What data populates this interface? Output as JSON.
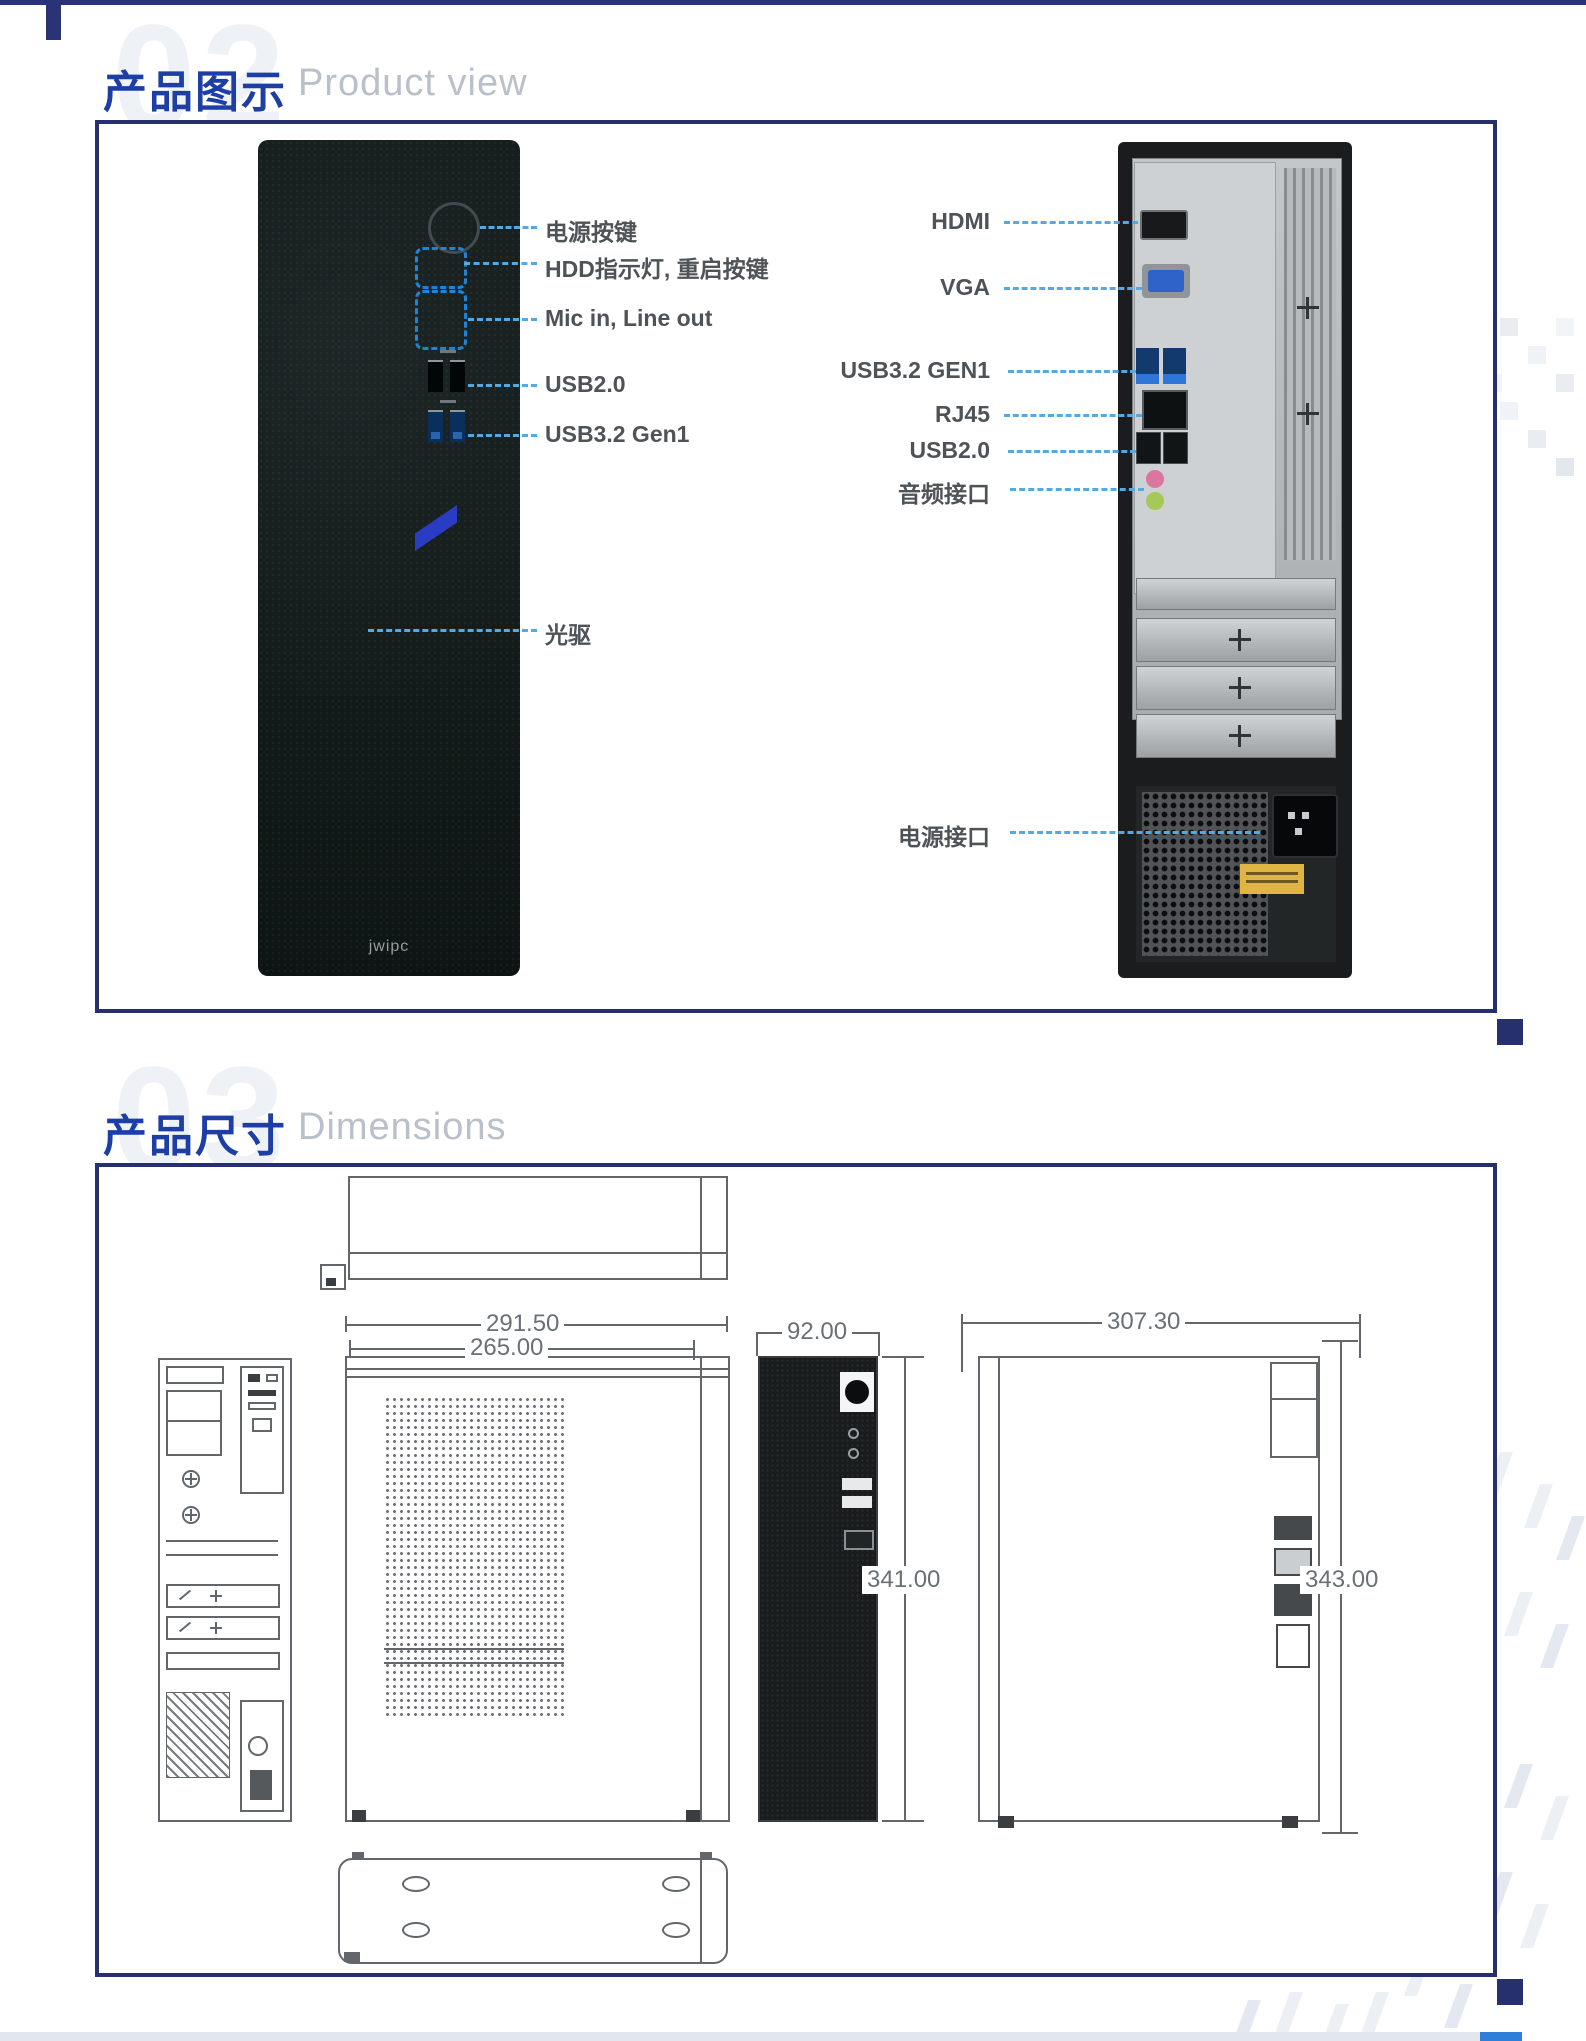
{
  "sections": {
    "product_view": {
      "number": "02",
      "title_zh": "产品图示",
      "title_en": "Product view"
    },
    "dimensions": {
      "number": "03",
      "title_zh": "产品尺寸",
      "title_en": "Dimensions"
    }
  },
  "product_view": {
    "logo_text": "jwipc",
    "front_labels": {
      "power": "电源按键",
      "hdd": "HDD指示灯, 重启按键",
      "mic": "Mic in, Line out",
      "usb2": "USB2.0",
      "usb3": "USB3.2 Gen1",
      "odd": "光驱"
    },
    "rear_labels": {
      "hdmi": "HDMI",
      "vga": "VGA",
      "usb3": "USB3.2 GEN1",
      "rj45": "RJ45",
      "usb2": "USB2.0",
      "audio": "音频接口",
      "power": "电源接口"
    }
  },
  "dimensions_mm": {
    "front_width_outer": "291.50",
    "front_width_inner": "265.00",
    "side_depth": "92.00",
    "front_height": "341.00",
    "rear_width": "307.30",
    "rear_height": "343.00"
  },
  "colors": {
    "accent_navy": "#27306e",
    "title_blue": "#1c3ea5",
    "subtitle_gray": "#b9c0ca",
    "leader_blue": "#55a9e3",
    "label_gray": "#4e5358",
    "warn_yellow": "#e0b544"
  }
}
